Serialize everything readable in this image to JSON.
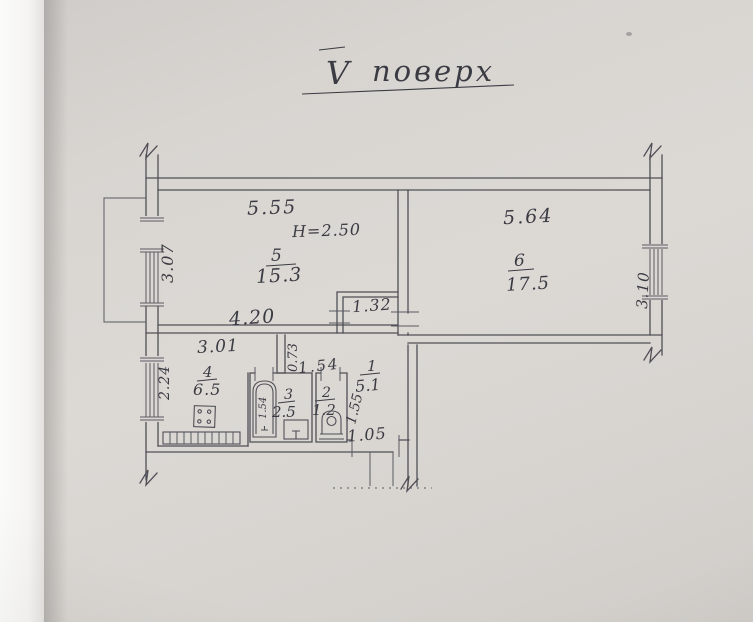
{
  "title": {
    "numeral": "V",
    "word": "поверх"
  },
  "rooms": {
    "living": {
      "number": "5",
      "area": "15.3",
      "width_top": "5.55",
      "width_bottom": "4.20",
      "window_width": "3.07",
      "ceiling_height": "H=2.50"
    },
    "bedroom": {
      "number": "6",
      "area": "17.5",
      "width_top": "5.64",
      "window_width": "3.10"
    },
    "kitchen": {
      "number": "4",
      "area": "6.5",
      "width_top": "3.01",
      "window_width": "2.24"
    },
    "bathroom": {
      "number": "3",
      "area": "2.5",
      "width_top": "1.54",
      "tub_length": "1.54"
    },
    "wc": {
      "number": "2",
      "area": "1.2"
    },
    "hallway": {
      "number": "1",
      "area": "5.1",
      "depth": "1.55",
      "entry_door_width": "1.05"
    }
  },
  "dims": {
    "niche_width": "1.32",
    "kitchen_doorway_width": "0.73"
  },
  "colors": {
    "paper": "#dad7d3",
    "ink": "#3b3b43",
    "wall_line": "#4f4f56"
  }
}
